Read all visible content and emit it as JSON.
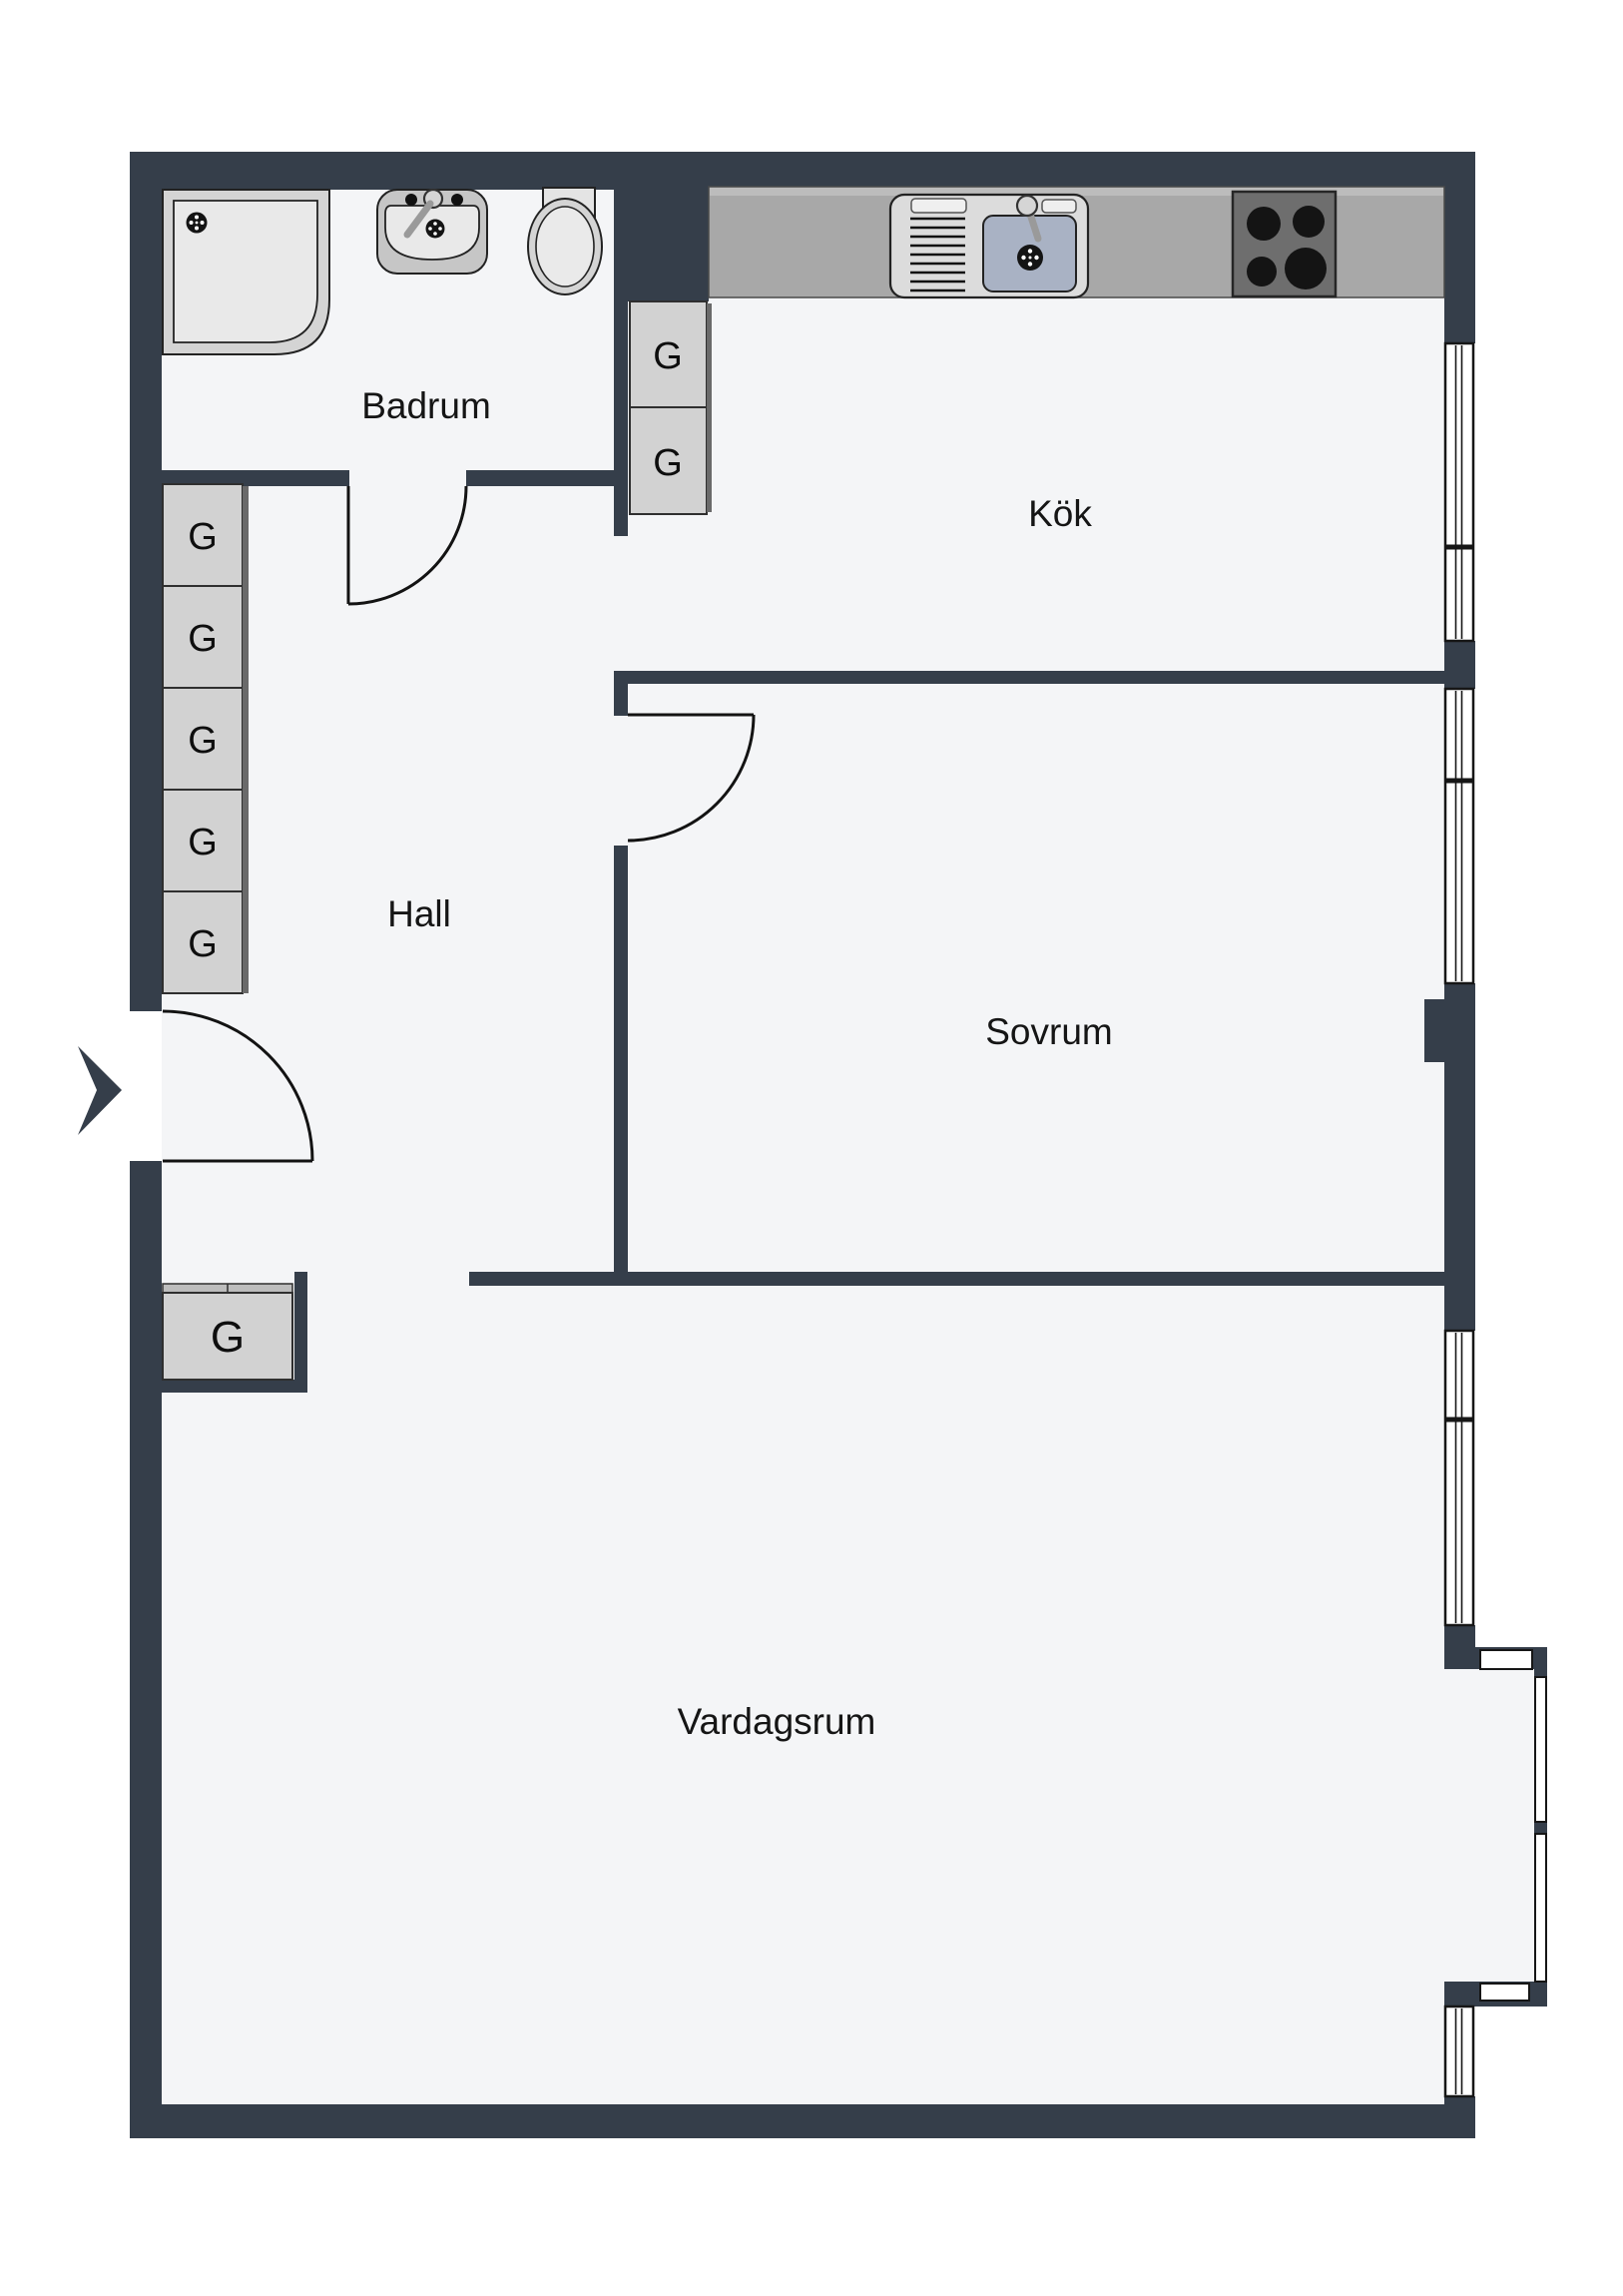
{
  "labels": {
    "rooms": {
      "badrum": "Badrum",
      "kok": "Kök",
      "hall": "Hall",
      "sovrum": "Sovrum",
      "vardagsrum": "Vardagsrum"
    },
    "wardrobe": "G"
  },
  "icons": {
    "entrance_arrow": "right-chevron",
    "fixtures": [
      "shower",
      "bathroom-sink",
      "toilet",
      "kitchen-sink",
      "stove"
    ]
  },
  "colors": {
    "wall": "#353E4A",
    "floor": "#F4F5F7",
    "outside": "#FFFFFF",
    "counter": "#A8A8A8",
    "closet": "#D2D2D2",
    "basin": "#A9B2C4",
    "stove": "#6E6E6E",
    "burner": "#141414",
    "text": "#151515"
  }
}
